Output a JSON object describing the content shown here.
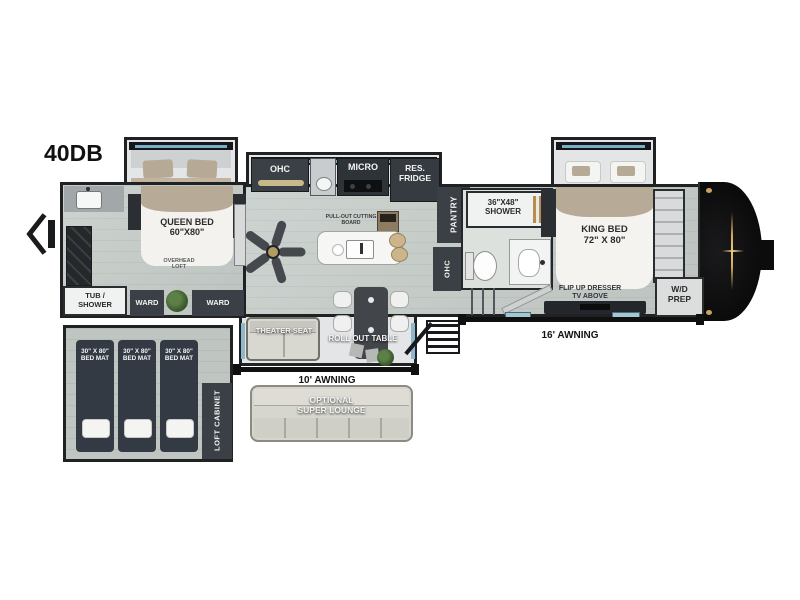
{
  "model": "40DB",
  "colors": {
    "wall": "#1f2122",
    "floor": "#c8cecb",
    "cabinet_dark": "#3a4046",
    "glass_blue": "#8fb9ca",
    "front_cap": "#0d0d0f",
    "gold_accent": "#d2a95e",
    "bedding_tan": "#b7aa96",
    "mat_dark": "#343a44",
    "lounge_gray": "#d6d6cf"
  },
  "labels": {
    "queen_bed": "QUEEN BED\n60\"X80\"",
    "overhead_loft": "OVERHEAD\nLOFT",
    "ohc_kitchen": "OHC",
    "micro": "MICRO",
    "res_fridge": "RES.\nFRIDGE",
    "cutting_board": "PULL-OUT CUTTING\nBOARD",
    "pantry": "PANTRY",
    "ohc_bath": "OHC",
    "mid_shower": "36\"X48\"\nSHOWER",
    "king_bed": "KING BED\n72\" X 80\"",
    "flip_dresser": "FLIP UP DRESSER\nTV ABOVE",
    "wd_prep": "W/D\nPREP",
    "tub_shower": "TUB /\nSHOWER",
    "ward_left": "WARD",
    "ward_right": "WARD",
    "theater_seat": "THEATER SEAT",
    "roll_out_table": "ROLL OUT TABLE",
    "awning_16": "16' AWNING",
    "awning_10": "10' AWNING",
    "super_lounge": "OPTIONAL\nSUPER LOUNGE",
    "bed_mats": [
      "30\" X 80\"\nBED MAT",
      "30\" X 80\"\nBED MAT",
      "30\" X 80\"\nBED MAT"
    ],
    "loft_cabinet": "LOFT CABINET"
  }
}
